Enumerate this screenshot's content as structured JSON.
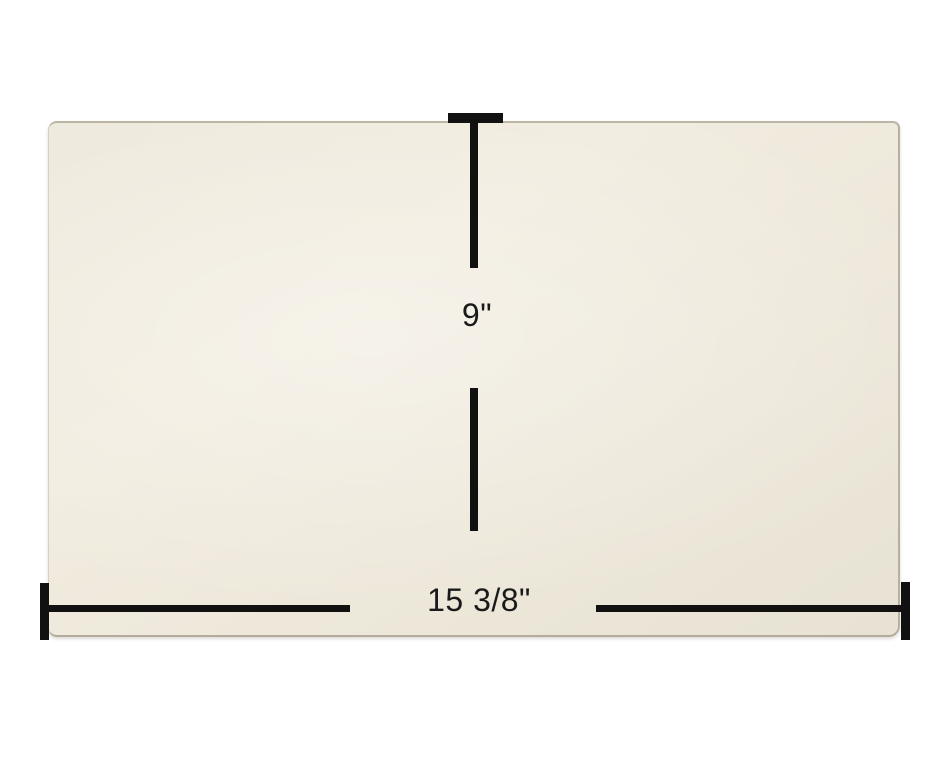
{
  "diagram": {
    "description": "Rectangular cream panel with measurement annotations",
    "measurements": {
      "height": {
        "label": "9\"",
        "orientation": "vertical"
      },
      "width": {
        "label": "15 3/8\"",
        "orientation": "horizontal"
      }
    },
    "colors": {
      "background": "#FFFFFF",
      "panel_fill": "#EEE9DC",
      "panel_edge": "#B7AF9F",
      "dimension_line": "#111111",
      "label_text": "#1A1A1A"
    }
  }
}
